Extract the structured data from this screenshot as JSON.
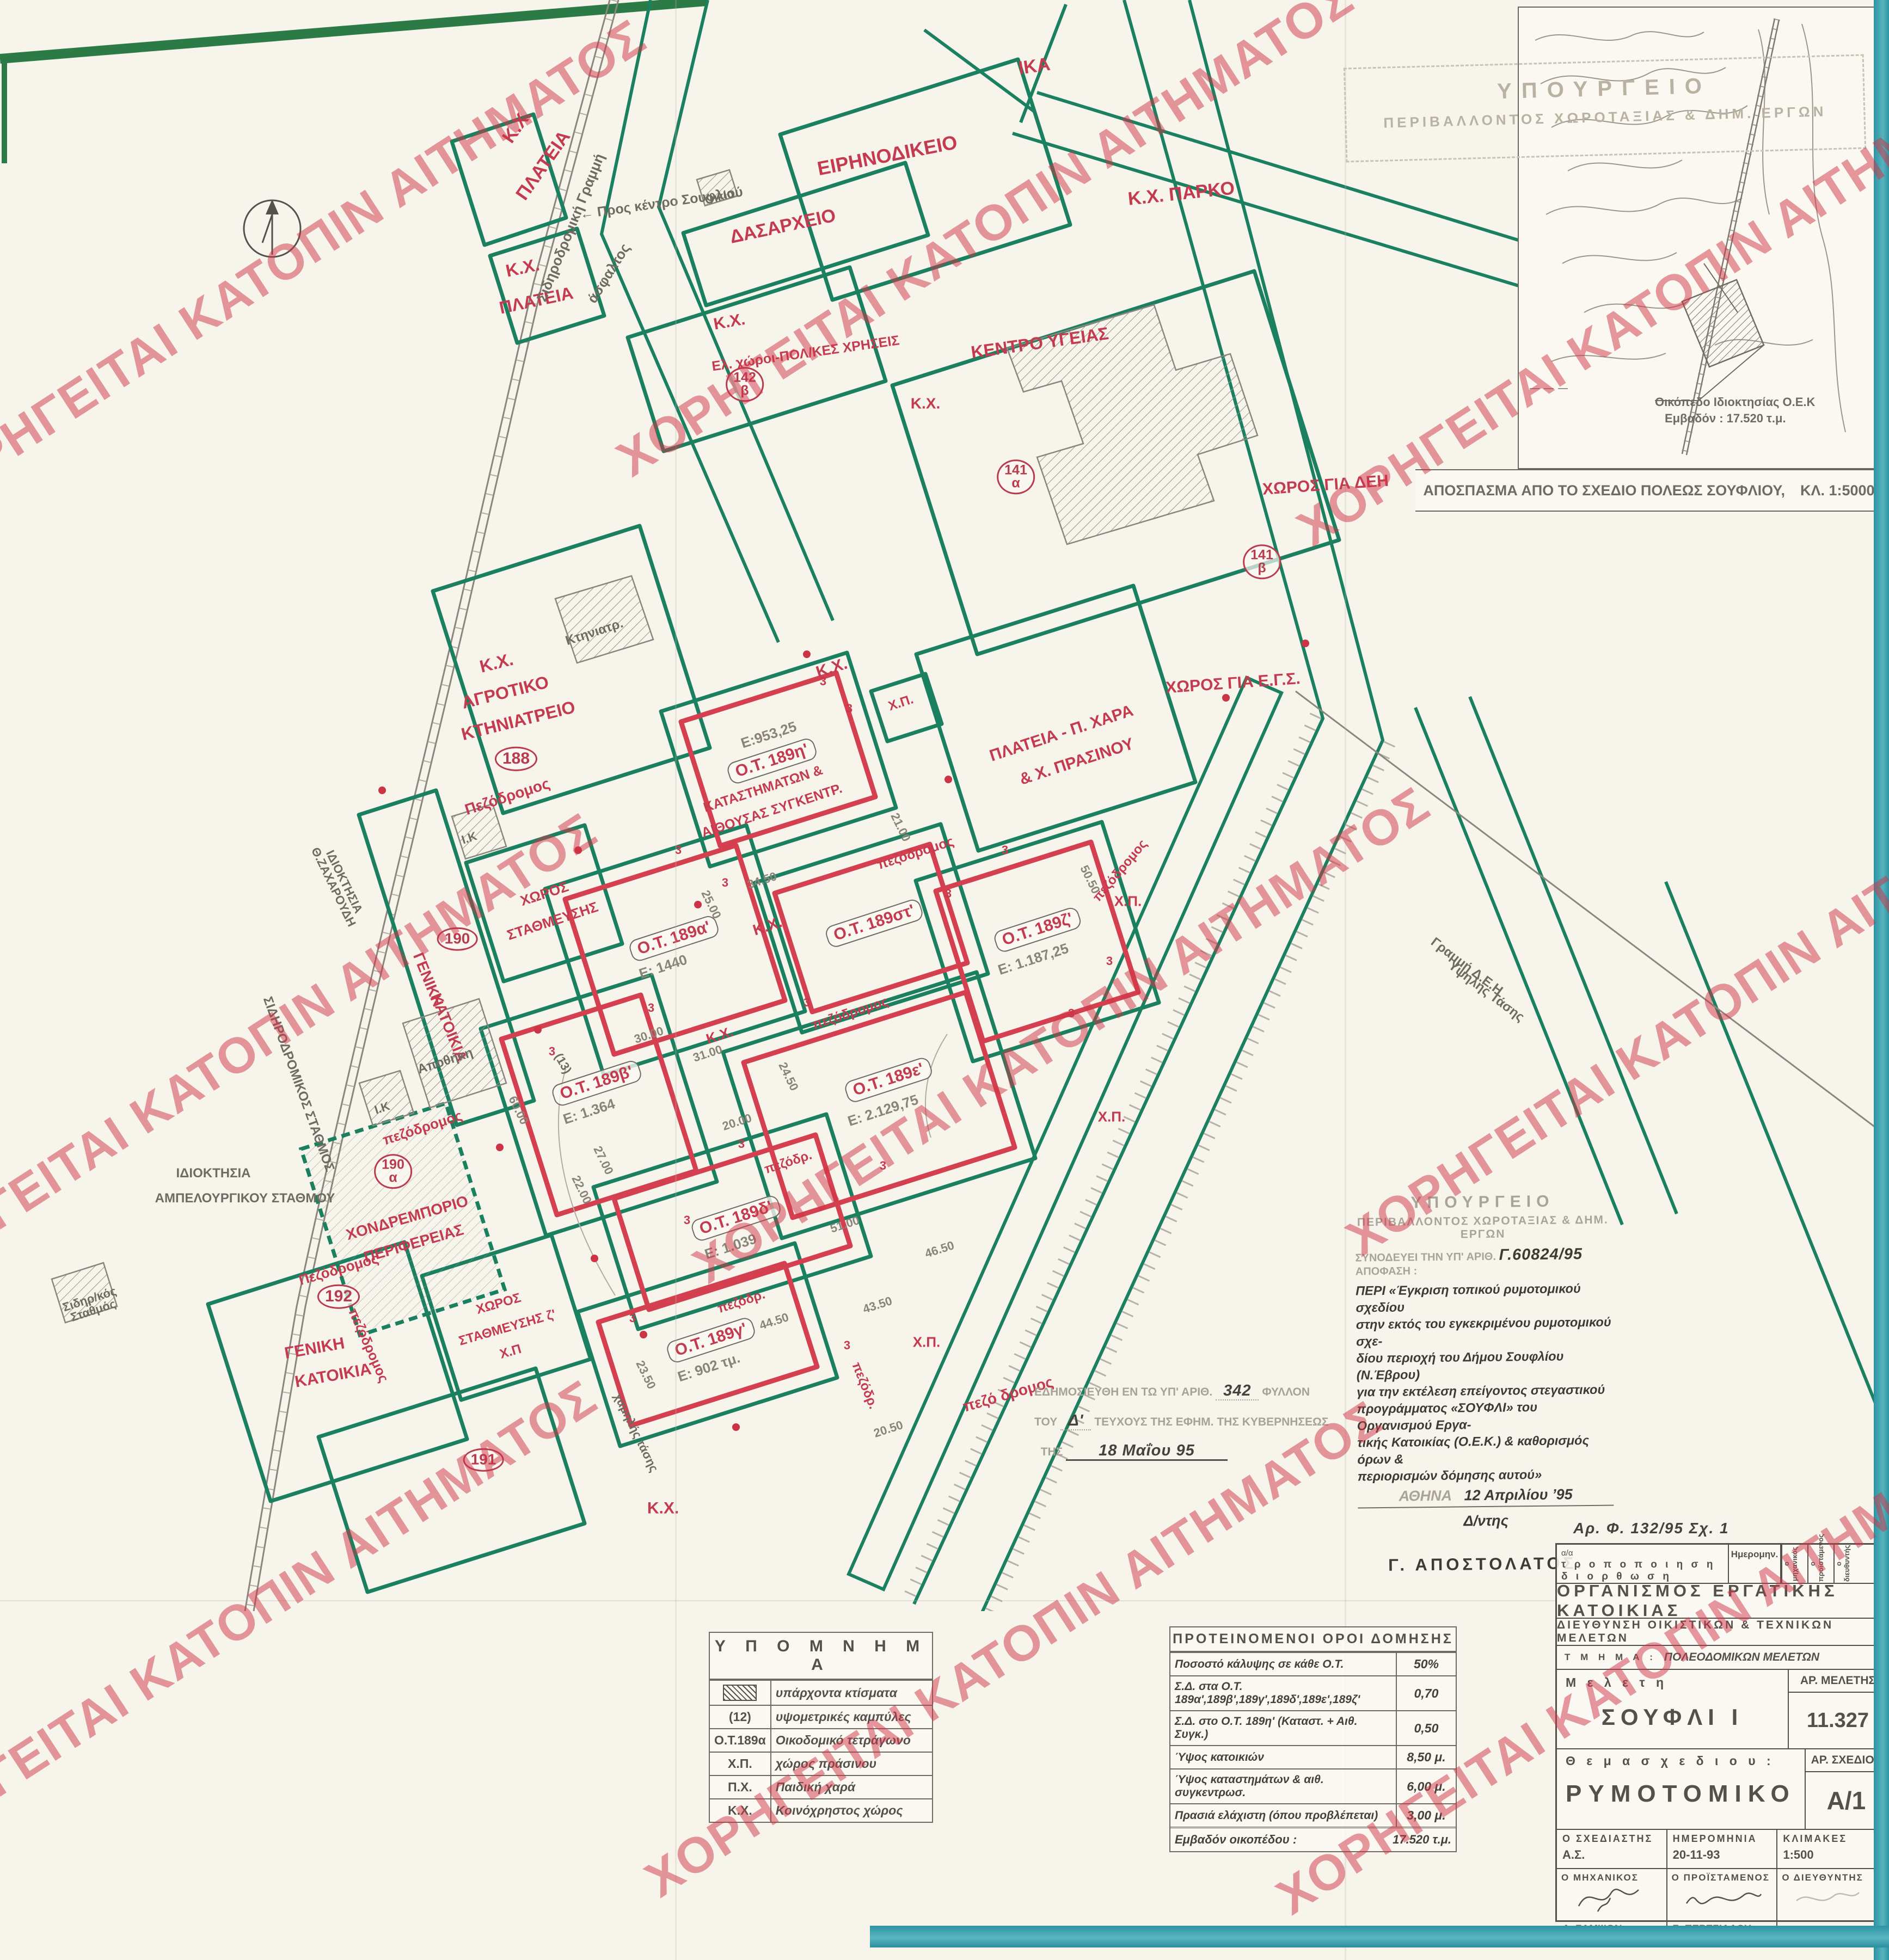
{
  "watermark": {
    "text": "ΧΟΡΗΓΕΙΤΑΙ ΚΑΤΟΠΙΝ ΑΙΤΗΜΑΤΟΣ",
    "color": "#d03446",
    "positions": [
      [
        510,
        492
      ],
      [
        1810,
        420
      ],
      [
        3060,
        548
      ],
      [
        420,
        1950
      ],
      [
        1950,
        1902
      ],
      [
        3150,
        1852
      ],
      [
        420,
        2992
      ],
      [
        1862,
        3030
      ],
      [
        3022,
        3062
      ]
    ]
  },
  "inset": {
    "caption": "ΑΠΟΣΠΑΣΜΑ ΑΠΟ ΤΟ ΣΧΕΔΙΟ ΠΟΛΕΩΣ ΣΟΥΦΛΙΟΥ,",
    "scale": "ΚΛ. 1:5000",
    "note1": "Οικόπεδο Ιδιοκτησίας Ο.Ε.Κ",
    "note2": "Εμβαδόν : 17.520 τ.μ."
  },
  "stamp_top": {
    "l1": "ΥΠΟΥΡΓΕΙΟ",
    "l2": "ΠΕΡΙΒΑΛΛΟΝΤΟΣ ΧΩΡΟΤΑΞΙΑΣ & ΔΗΜ. ΕΡΓΩΝ"
  },
  "approval": {
    "m1": "ΥΠΟΥΡΓΕΙΟ",
    "m2": "ΠΕΡΙΒΑΛΛΟΝΤΟΣ ΧΩΡΟΤΑΞΙΑΣ & ΔΗΜ. ΕΡΓΩΝ",
    "ref_prefix": "ΣΥΝΟΔΕΥΕΙ ΤΗΝ ΥΠ' ΑΡΙΘ.",
    "ref_number": "Γ.60824/95",
    "ref_suffix": "ΑΠΟΦΑΣΗ :",
    "body": [
      "ΠΕΡΙ «Έγκριση τοπικού ρυμοτομικού σχεδίου",
      "στην εκτός του εγκεκριμένου ρυμοτομικού σχε-",
      "δίου περιοχή του Δήμου Σουφλίου (Ν.Έβρου)",
      "για την εκτέλεση επείγοντος στεγαστικού",
      "προγράμματος «ΣΟΥΦΛΙ» του Οργανισμού Εργα-",
      "τικής Κατοικίας (Ο.Ε.Κ.) & καθορισμός όρων &",
      "περιορισμών δόμησης αυτού»"
    ],
    "place": "ΑΘΗΝΑ",
    "date": "12 Απριλίου   ’95",
    "role": "Δ/ντης",
    "signature": "Γ. ΑΠΟΣΤΟΛΑΤΟΣ."
  },
  "gazette": {
    "l1a": "ΕΔΗΜΟΣΙΕΥΘΗ ΕΝ ΤΩ ΥΠ' ΑΡΙΘ.",
    "l1b": "342",
    "l1c": "ΦΥΛΛΟΝ",
    "l2a": "ΤΟΥ",
    "l2b": "Δ'",
    "l2c": "ΤΕΥΧΟΥΣ ΤΗΣ ΕΦΗΜ. ΤΗΣ ΚΥΒΕΡΝΗΣΕΩΣ",
    "l3a": "ΤΗΣ",
    "l3b": "18 Μαΐου        95"
  },
  "legend": {
    "title": "Υ Π Ο Μ Ν Η Μ Α",
    "rows": [
      {
        "sym": "",
        "symtype": "hatch",
        "desc": "υπάρχοντα κτίσματα"
      },
      {
        "sym": "(12)",
        "desc": "υψομετρικές καμπύλες"
      },
      {
        "sym": "Ο.Τ.189α",
        "desc": "Οικοδομικό τετράγωνο"
      },
      {
        "sym": "Χ.Π.",
        "desc": "χώρος πράσινου"
      },
      {
        "sym": "Π.Χ.",
        "desc": "Παιδική χαρά"
      },
      {
        "sym": "Κ.Χ.",
        "desc": "Κοινόχρηστος χώρος"
      }
    ]
  },
  "terms": {
    "title": "ΠΡΟΤΕΙΝΟΜΕΝΟΙ  ΟΡΟΙ  ΔΟΜΗΣΗΣ",
    "rows": [
      {
        "label": "Ποσοστό κάλυψης σε κάθε Ο.Τ.",
        "value": "50%"
      },
      {
        "label": "Σ.Δ. στα Ο.Τ. 189α',189β',189γ',189δ',189ε',189ζ'",
        "value": "0,70"
      },
      {
        "label": "Σ.Δ. στο Ο.Τ. 189η' (Καταστ. + Αιθ. Συγκ.)",
        "value": "0,50"
      },
      {
        "label": "Ύψος κατοικιών",
        "value": "8,50 μ."
      },
      {
        "label": "Ύψος καταστημάτων & αιθ. συγκεντρωσ.",
        "value": "6,00 μ."
      },
      {
        "label": "Πρασιά ελάχιστη (όπου προβλέπεται)",
        "value": "3,00 μ."
      }
    ],
    "footer_label": "Εμβαδόν οικοπέδου :",
    "footer_value": "17.520 τ.μ."
  },
  "title_block": {
    "annotation": "Αρ. Φ. 132/95      Σχ. 1",
    "rev_a": "α/α",
    "rev_b": "τ ρ ο π ο π ο ι η σ η",
    "rev_c": "δ ι ο ρ θ ω σ η",
    "rev_date": "Ημερομην.",
    "rev_s1": "ο μηχανικός",
    "rev_s2": "ο προϊστάμενος",
    "rev_s3": "ο διευθυντής",
    "org": "ΟΡΓΑΝΙΣΜΟΣ ΕΡΓΑΤΙΚΗΣ ΚΑΤΟΙΚΙΑΣ",
    "dept": "ΔΙΕΥΘΥΝΣΗ ΟΙΚΙΣΤΙΚΩΝ & ΤΕΧΝΙΚΩΝ ΜΕΛΕΤΩΝ",
    "section_label": "Τ Μ Η Μ Α :",
    "section_value": "ΠΟΛΕΟΔΟΜΙΚΩΝ ΜΕΛΕΤΩΝ",
    "study_label": "Μ ε λ ε τ η",
    "study_value": "ΣΟΥΦΛΙ  Ι",
    "study_no_label": "ΑΡ. ΜΕΛΕΤΗΣ",
    "study_no_value": "11.327",
    "subject_label": "Θ ε μ α  σ χ ε δ ι ο υ :",
    "subject_value": "ΡΥΜΟΤΟΜΙΚΟ",
    "drawing_no_label": "ΑΡ. ΣΧΕΔΙΟΥ",
    "drawing_no_value": "Α/1",
    "designer_label": "Ο ΣΧΕΔΙΑΣΤΗΣ",
    "designer_value": "Α.Σ.",
    "date_label": "ΗΜΕΡΟΜΗΝΙΑ",
    "date_value": "20-11-93",
    "scales_label": "ΚΛΙΜΑΚΕΣ",
    "scales_value": "1:500",
    "engineer_label": "Ο ΜΗΧΑΝΙΚΟΣ",
    "engineer_sig": "Α. ΣΑΜΨΩΝ",
    "supervisor_label": "Ο ΠΡΟΪΣΤΑΜΕΝΟΣ",
    "supervisor_sig": "Σ. ΠΕΡΕΣΙΑΔΟΥ",
    "director_label": "Ο ΔΙΕΥΘΥΝΤΗΣ",
    "director_sig": ""
  },
  "map": {
    "blocks": [
      {
        "id": "Ο.Τ. 189η'",
        "area": "Ε:953,25",
        "use": "ΚΑΤΑΣΤΗΜΑΤΩΝ & ΑΙΘΟΥΣΑΣ ΣΥΓΚΕΝΤΡ."
      },
      {
        "id": "Ο.Τ. 189α'",
        "area": "Ε: 1440"
      },
      {
        "id": "Ο.Τ. 189β'",
        "area": "Ε: 1.364"
      },
      {
        "id": "Ο.Τ. 189γ'",
        "area": "Ε: 902 τμ."
      },
      {
        "id": "Ο.Τ. 189δ'",
        "area": "Ε: 1.039"
      },
      {
        "id": "Ο.Τ. 189ε'",
        "area": "Ε: 2.129,75"
      },
      {
        "id": "Ο.Τ. 189στ'",
        "area": ""
      },
      {
        "id": "Ο.Τ. 189ζ'",
        "area": "Ε: 1.187,25"
      }
    ],
    "labels": [
      [
        "Κ.Χ.",
        950,
        232,
        -55,
        "red",
        34
      ],
      [
        "ΠΛΑΤΕΙΑ",
        998,
        304,
        -55,
        "red",
        34
      ],
      [
        "Κ.Χ.",
        960,
        492,
        -12,
        "red",
        32
      ],
      [
        "ΠΛΑΤΕΙΑ",
        985,
        552,
        -12,
        "red",
        32
      ],
      [
        "Σιδηροδρομική Γραμμή",
        1048,
        418,
        -68,
        "gray",
        26
      ],
      [
        "άσφαλτος",
        1118,
        502,
        -58,
        "gray",
        26
      ],
      [
        "← Προς κέντρο Σουφλιού",
        1215,
        374,
        -8,
        "gray",
        25
      ],
      [
        "Οικία",
        1322,
        362,
        -15,
        "gray",
        22
      ],
      [
        "ΕΙΡΗΝΟΔΙΚΕΙΟ",
        1630,
        286,
        -11,
        "red",
        36
      ],
      [
        "ΙΚΑ",
        1900,
        122,
        -8,
        "red",
        34
      ],
      [
        "ΔΑΣΑΡΧΕΙΟ",
        1438,
        416,
        -12,
        "red",
        34
      ],
      [
        "Κ.Χ.  ΠΑΡΚΟ",
        2170,
        356,
        -6,
        "red",
        34
      ],
      [
        "Κ.Χ.",
        1340,
        592,
        -10,
        "red",
        30
      ],
      [
        "Ελ. χώροι-ΠΟΛ/ΚΕΣ ΧΡΗΣΕΙΣ",
        1480,
        650,
        -8,
        "red",
        25
      ],
      [
        "142\nβ",
        1368,
        706,
        0,
        "circle",
        25
      ],
      [
        "ΚΕΝΤΡΟ  ΥΓΕΙΑΣ",
        1910,
        630,
        -8,
        "red",
        32
      ],
      [
        "Κ.Χ.",
        1700,
        742,
        0,
        "red",
        28
      ],
      [
        "141\nα",
        1866,
        876,
        0,
        "circle",
        25
      ],
      [
        "ΧΩΡΟΣ ΓΙΑ ΔΕΗ",
        2435,
        892,
        -4,
        "red",
        30
      ],
      [
        "141\nβ",
        2318,
        1032,
        0,
        "circle",
        25
      ],
      [
        "ΧΩΡΟΣ ΓΙΑ Ε.Γ.Σ.",
        2265,
        1256,
        -4,
        "red",
        30
      ],
      [
        "Κ.Χ.",
        912,
        1218,
        -14,
        "red",
        32
      ],
      [
        "ΑΓΡΟΤΙΚΟ",
        928,
        1272,
        -14,
        "red",
        32
      ],
      [
        "ΚΤΗΝΙΑΤΡΕΙΟ",
        952,
        1324,
        -14,
        "red",
        32
      ],
      [
        "188",
        948,
        1394,
        0,
        "circle",
        30
      ],
      [
        "Κτηνιατρ.",
        1092,
        1162,
        -18,
        "gray",
        24
      ],
      [
        "Πεζόδρομος",
        932,
        1464,
        -18,
        "red",
        28
      ],
      [
        "ΙΔΙΟΚΤΗΣΙΑ\nΘ.ΖΑΧΑΡΟΥΔΗ",
        622,
        1625,
        64,
        "gray",
        22
      ],
      [
        "Ι.Κ",
        862,
        1540,
        -18,
        "gray",
        22
      ],
      [
        "190",
        840,
        1725,
        0,
        "circle",
        28
      ],
      [
        "ΓΕΝΙΚΗ",
        786,
        1800,
        68,
        "red",
        28
      ],
      [
        "ΚΑΤΟΙΚΙΑ",
        824,
        1888,
        68,
        "red",
        28
      ],
      [
        "πεζόδρομος",
        776,
        2072,
        -18,
        "red",
        26
      ],
      [
        "Αποθήκη",
        818,
        1950,
        -18,
        "gray",
        24
      ],
      [
        "Ι.Κ",
        702,
        2036,
        -18,
        "gray",
        22
      ],
      [
        "ΣΙΔΗΡΟΔΡΟΜΙΚΟΣ ΣΤΑΘΜΟΣ",
        548,
        1992,
        70,
        "gray",
        24
      ],
      [
        "ΙΔΙΟΚΤΗΣΙΑ",
        392,
        2156,
        0,
        "gray",
        24
      ],
      [
        "ΑΜΠΕΛΟΥΡΓΙΚΟΥ ΣΤΑΘΜΟΥ",
        450,
        2202,
        0,
        "gray",
        24
      ],
      [
        "190\nα",
        722,
        2152,
        0,
        "circle",
        25
      ],
      [
        "ΧΟΝΔΡΕΜΠΟΡΙΟ",
        748,
        2238,
        -16,
        "red",
        28
      ],
      [
        "ΠΕΡΙΦΕΡΕΙΑΣ",
        760,
        2285,
        -16,
        "red",
        28
      ],
      [
        "Πεζόδρομος",
        622,
        2332,
        -16,
        "red",
        26
      ],
      [
        "Σιδηρ/κός\nΣταθμός",
        168,
        2398,
        -18,
        "gray",
        22
      ],
      [
        "192",
        622,
        2382,
        0,
        "circle",
        30
      ],
      [
        "ΓΕΝΙΚΗ",
        578,
        2478,
        -10,
        "red",
        30
      ],
      [
        "ΚΑΤΟΙΚΙΑ",
        612,
        2528,
        -10,
        "red",
        30
      ],
      [
        "πεζόδρομος",
        676,
        2472,
        66,
        "red",
        25
      ],
      [
        "191",
        888,
        2682,
        0,
        "circle",
        28
      ],
      [
        "Κ.Χ.",
        1218,
        2772,
        0,
        "red",
        30
      ],
      [
        "Κ.Χ.",
        1528,
        1228,
        -18,
        "red",
        30
      ],
      [
        "Ε:953,25",
        1412,
        1350,
        -18,
        "dim",
        26
      ],
      [
        "Ο.Τ. 189η'",
        1418,
        1398,
        -18,
        "otbox",
        30
      ],
      [
        "ΚΑΤΑΣΤΗΜΑΤΩΝ &",
        1402,
        1450,
        -18,
        "red",
        25
      ],
      [
        "ΑΙΘΟΥΣΑΣ ΣΥΓΚΕΝΤΡ.",
        1418,
        1490,
        -18,
        "red",
        25
      ],
      [
        "Χ.Π.",
        1655,
        1292,
        -18,
        "red",
        24
      ],
      [
        "ΠΛΑΤΕΙΑ  -  Π. ΧΑΡΑ",
        1950,
        1348,
        -18,
        "red",
        30
      ],
      [
        "& Χ. ΠΡΑΣΙΝΟΥ",
        1978,
        1400,
        -18,
        "red",
        30
      ],
      [
        "πεζόδρομος",
        1682,
        1568,
        -18,
        "red",
        25
      ],
      [
        "ΧΩΡΟΣ",
        1000,
        1642,
        -18,
        "red",
        26
      ],
      [
        "ΣΤΑΘΜΕΥΣΗΣ",
        1015,
        1692,
        -18,
        "red",
        26
      ],
      [
        "Ο.Τ. 189α'",
        1238,
        1724,
        -18,
        "otbox",
        30
      ],
      [
        "Ε: 1440",
        1218,
        1776,
        -18,
        "dim",
        26
      ],
      [
        "Κ.Χ.",
        1410,
        1702,
        -18,
        "red",
        28
      ],
      [
        "Ο.Τ. 189στ'",
        1606,
        1696,
        -18,
        "otbox",
        30
      ],
      [
        "Ο.Τ. 189ζ'",
        1906,
        1708,
        -18,
        "otbox",
        30
      ],
      [
        "Ε: 1.187,25",
        1898,
        1762,
        -18,
        "dim",
        26
      ],
      [
        "Χ.Π.",
        2072,
        1656,
        0,
        "red",
        26
      ],
      [
        "πεζόδρομος",
        2058,
        1600,
        -50,
        "red",
        24
      ],
      [
        "Ο.Τ. 189ε'",
        1632,
        1984,
        -18,
        "otbox",
        30
      ],
      [
        "Ε: 2.129,75",
        1622,
        2040,
        -18,
        "dim",
        26
      ],
      [
        "Ο.Τ. 189β'",
        1096,
        1990,
        -18,
        "otbox",
        30
      ],
      [
        "Ε: 1.364",
        1082,
        2042,
        -18,
        "dim",
        26
      ],
      [
        "πεζόδρομος",
        1562,
        1862,
        -18,
        "red",
        25
      ],
      [
        "Κ.Χ.",
        1322,
        1902,
        -18,
        "red",
        26
      ],
      [
        "Ο.Τ. 189δ'",
        1352,
        2238,
        -18,
        "otbox",
        30
      ],
      [
        "Ε: 1.039",
        1342,
        2290,
        -18,
        "dim",
        26
      ],
      [
        "πεζόδρ.",
        1448,
        2136,
        -18,
        "red",
        24
      ],
      [
        "Χ.Π.",
        2042,
        2052,
        0,
        "red",
        26
      ],
      [
        "Ο.Τ. 189γ'",
        1306,
        2462,
        -18,
        "otbox",
        30
      ],
      [
        "Ε: 902 τμ.",
        1302,
        2512,
        -18,
        "dim",
        26
      ],
      [
        "πεζόδρ.",
        1362,
        2392,
        -18,
        "red",
        24
      ],
      [
        "πεζόδρ.",
        1588,
        2546,
        68,
        "red",
        24
      ],
      [
        "Χ.Π.",
        1702,
        2466,
        0,
        "red",
        26
      ],
      [
        "πεζό δρομος",
        1852,
        2562,
        -16,
        "red",
        28
      ],
      [
        "ΧΩΡΟΣ",
        916,
        2396,
        -16,
        "red",
        24
      ],
      [
        "ΣΤΑΘΜΕΥΣΗΣ ζ'",
        932,
        2440,
        -16,
        "red",
        24
      ],
      [
        "Χ.Π",
        938,
        2484,
        -16,
        "red",
        24
      ],
      [
        "Γραμμή Δ.Ε.Η",
        2694,
        1776,
        37,
        "gray",
        24
      ],
      [
        "Υψηλής Τάσης",
        2730,
        1822,
        37,
        "gray",
        24
      ],
      [
        "χαμηλής τάσης",
        1168,
        2632,
        64,
        "gray",
        22
      ],
      [
        "(13)",
        1034,
        1954,
        60,
        "gray",
        22
      ],
      [
        "34.50",
        1400,
        1618,
        -18,
        "dim",
        22
      ],
      [
        "25.00",
        1306,
        1662,
        64,
        "dim",
        22
      ],
      [
        "50.50",
        2002,
        1616,
        64,
        "dim",
        22
      ],
      [
        "30.00",
        1192,
        1902,
        -18,
        "dim",
        22
      ],
      [
        "31.00",
        1300,
        1936,
        -18,
        "dim",
        22
      ],
      [
        "21.00",
        1654,
        1520,
        64,
        "dim",
        22
      ],
      [
        "27.00",
        1108,
        2132,
        64,
        "dim",
        22
      ],
      [
        "22.00",
        1068,
        2186,
        64,
        "dim",
        22
      ],
      [
        "24.50",
        1448,
        1978,
        64,
        "dim",
        22
      ],
      [
        "51.00",
        1552,
        2250,
        -18,
        "dim",
        22
      ],
      [
        "46.50",
        1726,
        2296,
        -18,
        "dim",
        22
      ],
      [
        "44.50",
        1422,
        2428,
        -18,
        "dim",
        22
      ],
      [
        "43.50",
        1612,
        2398,
        -18,
        "dim",
        22
      ],
      [
        "60.00",
        952,
        2040,
        64,
        "dim",
        22
      ],
      [
        "20.50",
        1632,
        2626,
        -18,
        "dim",
        22
      ],
      [
        "23.50",
        1186,
        2526,
        64,
        "dim",
        22
      ],
      [
        "20.00",
        1354,
        2062,
        -18,
        "dim",
        22
      ],
      [
        "3",
        1246,
        1562,
        0,
        "mark",
        22
      ],
      [
        "3",
        1512,
        1252,
        0,
        "mark",
        22
      ],
      [
        "3",
        1332,
        1622,
        0,
        "mark",
        22
      ],
      [
        "3",
        1742,
        1642,
        0,
        "mark",
        22
      ],
      [
        "3",
        1846,
        1562,
        0,
        "mark",
        22
      ],
      [
        "3",
        1482,
        1842,
        0,
        "mark",
        22
      ],
      [
        "3",
        1196,
        1852,
        0,
        "mark",
        22
      ],
      [
        "3",
        1014,
        1932,
        0,
        "mark",
        22
      ],
      [
        "3",
        1362,
        2102,
        0,
        "mark",
        22
      ],
      [
        "3",
        1622,
        2142,
        0,
        "mark",
        22
      ],
      [
        "3",
        1262,
        2242,
        0,
        "mark",
        22
      ],
      [
        "3",
        1162,
        2422,
        0,
        "mark",
        22
      ],
      [
        "3",
        1556,
        2472,
        0,
        "mark",
        22
      ],
      [
        "3",
        1968,
        1862,
        0,
        "mark",
        22
      ],
      [
        "3",
        2038,
        1766,
        0,
        "mark",
        22
      ],
      [
        "3",
        1560,
        1302,
        0,
        "mark",
        22
      ]
    ],
    "dots": [
      [
        1482,
        1202
      ],
      [
        1742,
        1432
      ],
      [
        1282,
        1662
      ],
      [
        1062,
        1562
      ],
      [
        988,
        1892
      ],
      [
        918,
        2108
      ],
      [
        1092,
        2312
      ],
      [
        1182,
        2452
      ],
      [
        1352,
        2622
      ],
      [
        2252,
        1282
      ],
      [
        2398,
        1182
      ],
      [
        702,
        1452
      ]
    ]
  }
}
